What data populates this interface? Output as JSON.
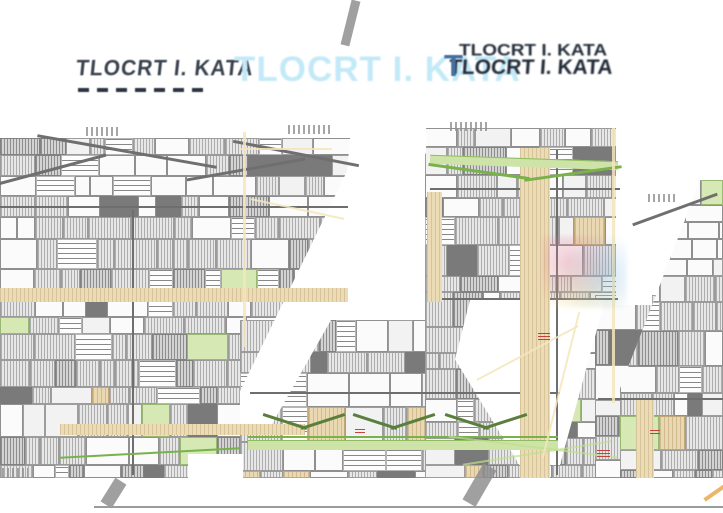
{
  "titles": {
    "left": "TLOCRT I. KATA",
    "center": "TLOCRT I. KATA",
    "right_top": "TLOCRT I. KATA",
    "right_bottom": "TLOCRT I. KATA",
    "right_initial": "T"
  },
  "colors": {
    "title_left": "#39424e",
    "title_center": "#c3e9f8",
    "title_right": "#1f2835",
    "title_right_initial": "#44709f",
    "plan_hatch": "#adadad",
    "plan_tan": "#ead8b2",
    "plan_green": "#79b24a",
    "plan_yellow_faint": "#f3e6bb",
    "plan_red_mark": "#c03030",
    "bottom_rule": "#9b9b9b"
  },
  "floorplan": {
    "seed": 987654321,
    "cell_types": [
      [
        "hatch",
        0.38
      ],
      [
        "room",
        0.24
      ],
      [
        "hatchd",
        0.12
      ],
      [
        "room2",
        0.08
      ],
      [
        "wall",
        0.06
      ],
      [
        "text",
        0.07
      ],
      [
        "tan",
        0.03
      ],
      [
        "green",
        0.02
      ]
    ],
    "masses": [
      {
        "name": "wing-left",
        "x": 0,
        "y": 138,
        "w": 352,
        "h": 340,
        "clip": "polygon(0 0, 100% 0, 100% 15%, 70% 100%, 0 100%)"
      },
      {
        "name": "wing-center-bottom",
        "x": 240,
        "y": 320,
        "w": 330,
        "h": 158
      },
      {
        "name": "wing-middle-tower",
        "x": 425,
        "y": 128,
        "w": 195,
        "h": 350
      },
      {
        "name": "wing-right-bottom",
        "x": 595,
        "y": 295,
        "w": 128,
        "h": 183
      },
      {
        "name": "wing-right-stepped",
        "x": 620,
        "y": 180,
        "w": 103,
        "h": 298,
        "clip": "polygon(78% 0, 100% 0, 100% 100%, 0 100%, 0 70%)"
      }
    ],
    "overlays": [
      {
        "t": "white",
        "name": "gap-wedge-left",
        "x": 240,
        "y": 128,
        "w": 188,
        "h": 306,
        "clip": "polygon(59% 0, 99% 0, 99% 8%, 14% 100%, 0 100%, 0 86%, 57% 14%)"
      },
      {
        "t": "white",
        "name": "gap-pocket-center",
        "x": 455,
        "y": 300,
        "w": 150,
        "h": 165,
        "clip": "polygon(10% 0, 100% 0, 70% 100%, 43% 100%, 0 36%)"
      },
      {
        "t": "white",
        "name": "gap-right",
        "x": 616,
        "y": 125,
        "w": 36,
        "h": 180
      },
      {
        "t": "white",
        "name": "gap-bottom-left",
        "x": 188,
        "y": 454,
        "w": 55,
        "h": 24
      },
      {
        "t": "gline",
        "name": "roof-gable",
        "x": -4,
        "y": 168,
        "w": 112,
        "h": 3,
        "rot": -15
      },
      {
        "t": "gline",
        "name": "roof-gable",
        "x": 36,
        "y": 150,
        "w": 182,
        "h": 3,
        "rot": 10
      },
      {
        "t": "gline",
        "name": "roof-gable",
        "x": 186,
        "y": 168,
        "w": 120,
        "h": 3,
        "rot": -10
      },
      {
        "t": "gline",
        "name": "roof-gable",
        "x": 232,
        "y": 152,
        "w": 128,
        "h": 3,
        "rot": 11
      },
      {
        "t": "gline",
        "name": "roof-gable",
        "x": 630,
        "y": 208,
        "w": 90,
        "h": 3,
        "rot": -20
      },
      {
        "t": "wall",
        "name": "plan-wall",
        "x": 0,
        "y": 206,
        "w": 348,
        "h": 2
      },
      {
        "t": "wall",
        "name": "plan-wall",
        "x": 0,
        "y": 300,
        "w": 345,
        "h": 2
      },
      {
        "t": "wall",
        "name": "plan-wall",
        "x": 430,
        "y": 188,
        "w": 190,
        "h": 2
      },
      {
        "t": "wall",
        "name": "plan-wall",
        "x": 430,
        "y": 298,
        "w": 188,
        "h": 2
      },
      {
        "t": "wall",
        "name": "plan-wall",
        "x": 250,
        "y": 392,
        "w": 310,
        "h": 2
      },
      {
        "t": "wall",
        "name": "plan-wall",
        "x": 598,
        "y": 398,
        "w": 125,
        "h": 2
      },
      {
        "t": "wall",
        "name": "plan-wall",
        "x": 132,
        "y": 210,
        "w": 2,
        "h": 265
      },
      {
        "t": "wall",
        "name": "plan-wall",
        "x": 556,
        "y": 150,
        "w": 2,
        "h": 325
      },
      {
        "t": "tan",
        "name": "corridor-band",
        "x": 520,
        "y": 148,
        "w": 30,
        "h": 330
      },
      {
        "t": "tan",
        "name": "corridor-band",
        "x": 427,
        "y": 192,
        "w": 15,
        "h": 110
      },
      {
        "t": "tan",
        "name": "corridor-band",
        "x": 0,
        "y": 288,
        "w": 348,
        "h": 14
      },
      {
        "t": "tan",
        "name": "corridor-band",
        "x": 60,
        "y": 424,
        "w": 245,
        "h": 11
      },
      {
        "t": "tan",
        "name": "corridor-band",
        "x": 636,
        "y": 400,
        "w": 18,
        "h": 78
      },
      {
        "t": "green-strip",
        "name": "balcony-strip",
        "x": 430,
        "y": 158,
        "w": 188,
        "h": 8,
        "rot": 2
      },
      {
        "t": "green-line",
        "name": "roof-edge-green",
        "x": 428,
        "y": 170,
        "w": 102,
        "h": 3,
        "rot": 8
      },
      {
        "t": "green-line",
        "name": "roof-edge-green",
        "x": 524,
        "y": 172,
        "w": 98,
        "h": 3,
        "rot": -8
      },
      {
        "t": "green-strip",
        "name": "balcony-strip",
        "x": 248,
        "y": 440,
        "w": 310,
        "h": 9
      },
      {
        "t": "green-line",
        "name": "roof-edge-green",
        "x": 248,
        "y": 436,
        "w": 310,
        "h": 2
      },
      {
        "t": "green-chev",
        "name": "roof-chevron",
        "x": 262,
        "y": 420,
        "w": 46,
        "h": 3,
        "rot": 18
      },
      {
        "t": "green-chev",
        "name": "roof-chevron",
        "x": 300,
        "y": 420,
        "w": 46,
        "h": 3,
        "rot": -18
      },
      {
        "t": "green-chev",
        "name": "roof-chevron",
        "x": 352,
        "y": 420,
        "w": 46,
        "h": 3,
        "rot": 18
      },
      {
        "t": "green-chev",
        "name": "roof-chevron",
        "x": 390,
        "y": 420,
        "w": 46,
        "h": 3,
        "rot": -18
      },
      {
        "t": "green-chev",
        "name": "roof-chevron",
        "x": 444,
        "y": 420,
        "w": 46,
        "h": 3,
        "rot": 18
      },
      {
        "t": "green-chev",
        "name": "roof-chevron",
        "x": 482,
        "y": 420,
        "w": 46,
        "h": 3,
        "rot": -18
      },
      {
        "t": "gfaint",
        "name": "site-line-green",
        "x": 448,
        "y": 446,
        "w": 170,
        "h": 2,
        "rot": 7
      },
      {
        "t": "gfaint",
        "name": "site-line-green",
        "x": 462,
        "y": 452,
        "w": 150,
        "h": 2,
        "rot": -9
      },
      {
        "t": "green-line",
        "name": "site-curve-green",
        "x": 60,
        "y": 452,
        "w": 180,
        "h": 2,
        "rot": -3
      },
      {
        "t": "yline",
        "name": "site-line-yellow",
        "x": 612,
        "y": 128,
        "w": 3,
        "h": 275
      },
      {
        "t": "yline",
        "name": "site-line-yellow",
        "x": 243,
        "y": 132,
        "w": 3,
        "h": 215
      },
      {
        "t": "yline",
        "name": "site-line-yellow",
        "x": 240,
        "y": 148,
        "w": 92,
        "h": 2
      },
      {
        "t": "yline",
        "name": "site-line-yellow",
        "x": 250,
        "y": 208,
        "w": 95,
        "h": 2,
        "rot": 12
      },
      {
        "t": "yline",
        "name": "site-line-yellow",
        "x": 470,
        "y": 352,
        "w": 115,
        "h": 2,
        "rot": -28
      },
      {
        "t": "yline",
        "name": "site-line-yellow",
        "x": 560,
        "y": 310,
        "w": 2,
        "h": 150,
        "rot": 14
      },
      {
        "t": "oline",
        "name": "site-line-orange",
        "x": 702,
        "y": 490,
        "w": 28,
        "h": 4,
        "rot": -35
      },
      {
        "t": "wm",
        "name": "watermark",
        "x": 542,
        "y": 236,
        "w": 85,
        "h": 72
      },
      {
        "t": "gray-diag",
        "name": "artifact-diagonal-top",
        "x": 346,
        "y": 0,
        "w": 9,
        "h": 46,
        "rot": 14
      },
      {
        "t": "gray-diag",
        "name": "artifact-diagonal-bottom",
        "x": 107,
        "y": 479,
        "w": 13,
        "h": 28,
        "rot": 32
      },
      {
        "t": "gray-diag",
        "name": "artifact-diagonal-bottom",
        "x": 472,
        "y": 464,
        "w": 15,
        "h": 42,
        "rot": 30
      },
      {
        "t": "hline",
        "name": "bottom-rule-line",
        "x": 94,
        "y": 506,
        "w": 629,
        "h": 2
      },
      {
        "t": "red",
        "name": "red-dimension-mark",
        "x": 597,
        "y": 449,
        "w": 13,
        "h": 8
      },
      {
        "t": "red",
        "name": "red-dimension-mark",
        "x": 355,
        "y": 427,
        "w": 10,
        "h": 6
      },
      {
        "t": "red",
        "name": "red-dimension-mark",
        "x": 538,
        "y": 333,
        "w": 12,
        "h": 7
      },
      {
        "t": "red",
        "name": "red-dimension-mark",
        "x": 650,
        "y": 428,
        "w": 10,
        "h": 6
      },
      {
        "t": "tnoise",
        "name": "dimension-text",
        "x": 86,
        "y": 127,
        "w": 34,
        "h": 9
      },
      {
        "t": "tnoise",
        "name": "dimension-text",
        "x": 288,
        "y": 125,
        "w": 42,
        "h": 9
      },
      {
        "t": "tnoise",
        "name": "dimension-text",
        "x": 450,
        "y": 122,
        "w": 38,
        "h": 9
      },
      {
        "t": "tnoise",
        "name": "dimension-text",
        "x": 648,
        "y": 194,
        "w": 30,
        "h": 8
      },
      {
        "t": "tnoise",
        "name": "dimension-text",
        "x": 2,
        "y": 468,
        "w": 26,
        "h": 10
      }
    ]
  }
}
